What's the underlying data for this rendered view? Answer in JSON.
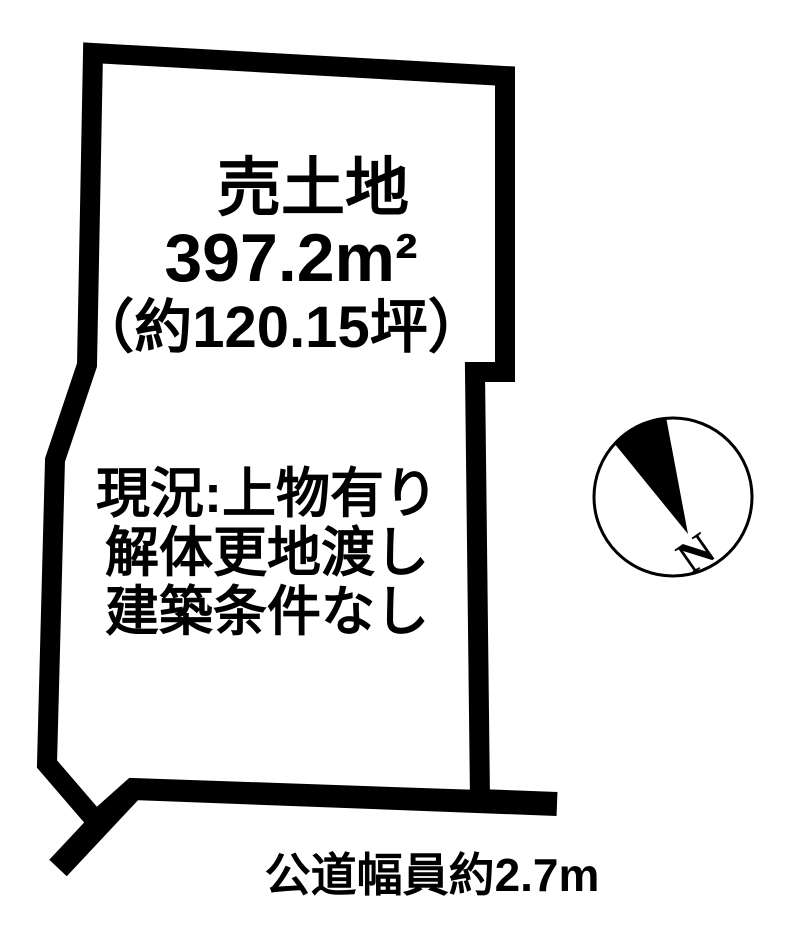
{
  "plot": {
    "title": "売土地",
    "area_m2": "397.2m²",
    "area_tsubo": "（約120.15坪）",
    "status_lines": [
      "現況:上物有り",
      "解体更地渡し",
      "建築条件なし"
    ]
  },
  "road": {
    "width_label": "公道幅員約2.7m"
  },
  "compass": {
    "north_label": "N"
  },
  "colors": {
    "outline": "#000000",
    "background": "#ffffff",
    "text": "#000000"
  }
}
